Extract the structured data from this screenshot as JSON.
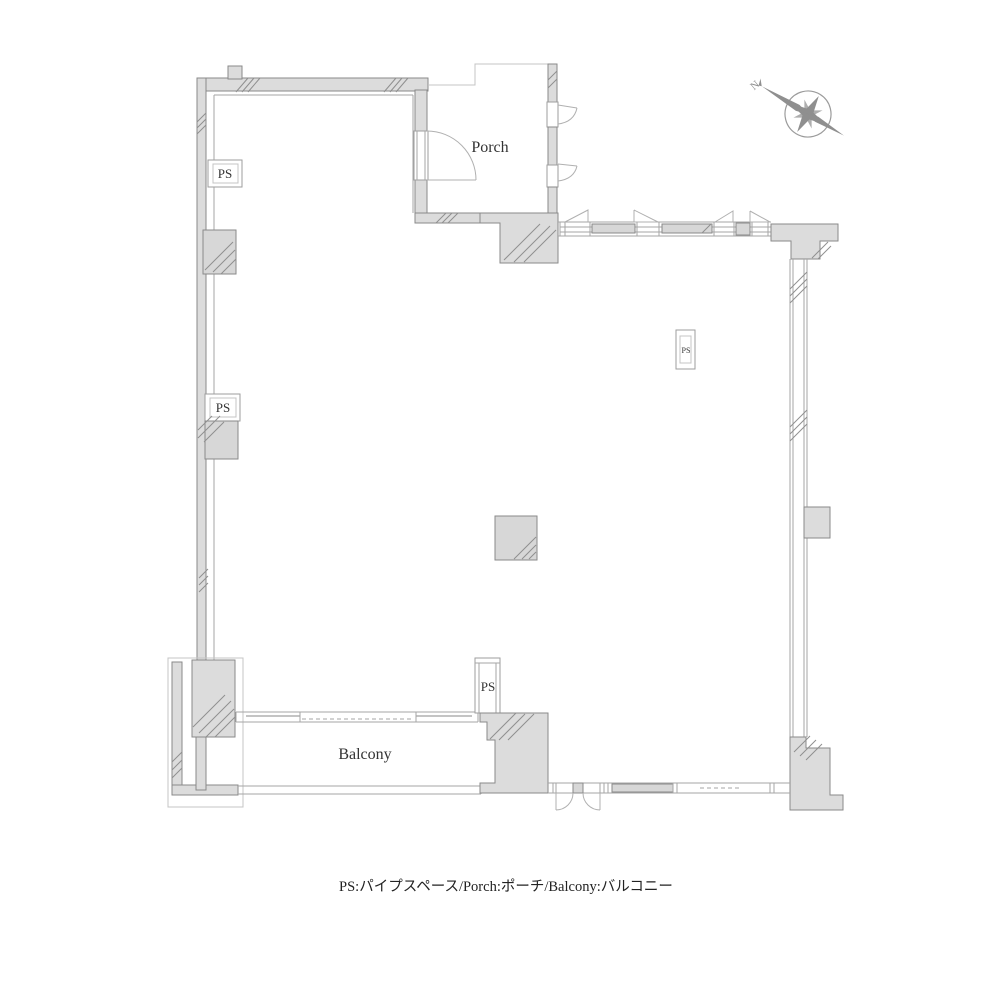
{
  "document": {
    "type": "floor-plan",
    "background": "#ffffff"
  },
  "labels": {
    "porch": "Porch",
    "balcony": "Balcony",
    "ps": "PS",
    "north": "N"
  },
  "legend": {
    "text": "PS:パイプスペース/Porch:ポーチ/Balcony:バルコニー"
  },
  "colors": {
    "wall_fill": "#dcdcdc",
    "wall_stroke": "#8a8a8a",
    "thin_line": "#a6a6a6",
    "light_line": "#c4c4c4",
    "text": "#333333",
    "compass": "#8f8f8f"
  }
}
